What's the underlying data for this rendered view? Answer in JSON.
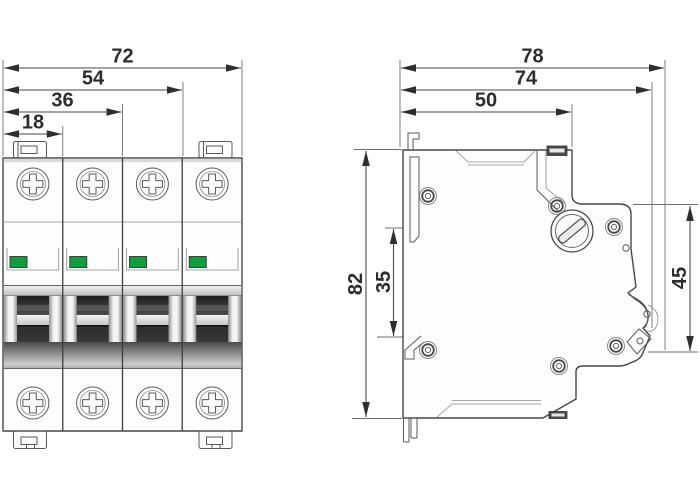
{
  "dimensions": {
    "front_widths": [
      "72",
      "54",
      "36",
      "18"
    ],
    "side_depths": [
      "78",
      "74",
      "50"
    ],
    "side_heights": [
      "82",
      "35",
      "45"
    ]
  },
  "colors": {
    "background": "#ffffff",
    "line": "#474747",
    "dim_text": "#2d2d2d",
    "indicator_green": "#0f9e3c",
    "toggle_dark": "#2a2a2a",
    "metal_gray": "#9e9e9e"
  },
  "icons": {
    "terminal_screw": "phillips-cross-in-circle",
    "case_rivet": "concentric-circles",
    "slotted_screw": "slotted-circle",
    "pole_indicator": "green-status-window",
    "din_rail_clip": "bracket-shape",
    "toggle_handle": "dark-window-with-bar"
  }
}
